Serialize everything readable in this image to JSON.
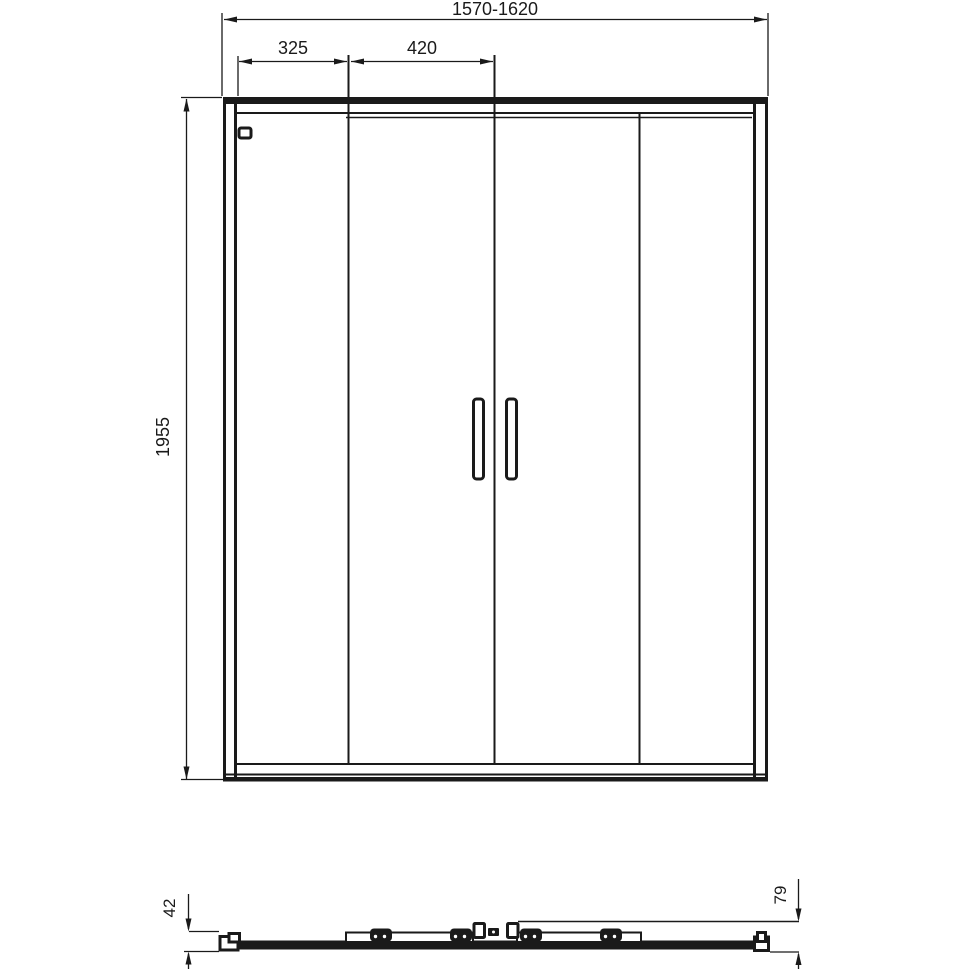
{
  "drawing": {
    "front_view": {
      "total_width": "1570-1620",
      "fixed_panel_width": "325",
      "sliding_panel_width": "420",
      "height": "1955"
    },
    "plan_view": {
      "profile_depth": "42",
      "total_depth": "79"
    },
    "colors": {
      "line": "#1a1a1a",
      "background": "#ffffff"
    }
  }
}
